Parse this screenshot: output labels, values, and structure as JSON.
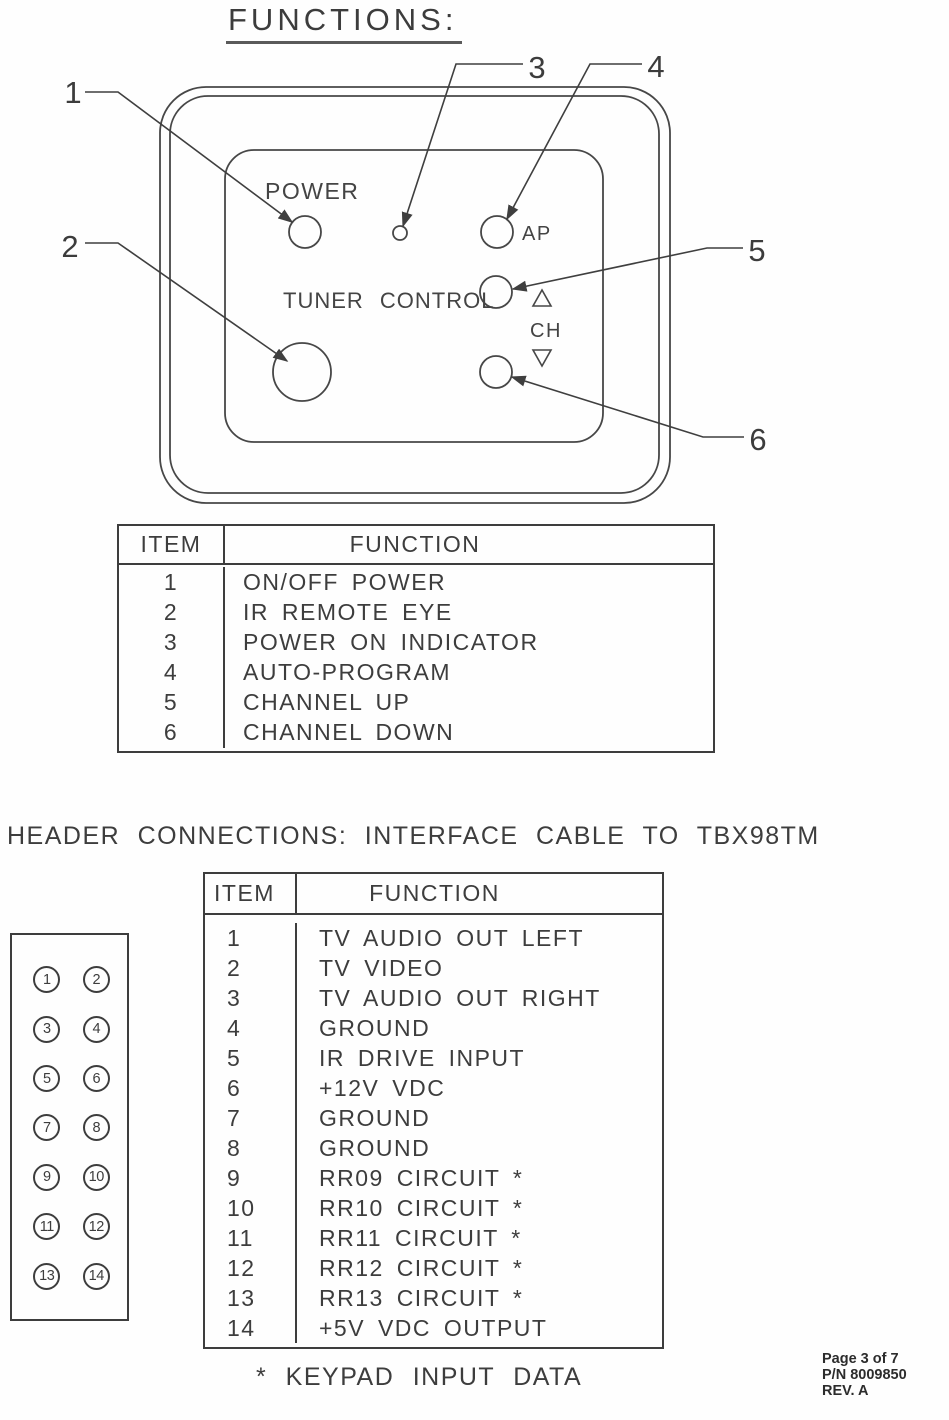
{
  "colors": {
    "paper": "#fefefe",
    "ink": "#3d3d3d"
  },
  "title": "FUNCTIONS:",
  "panel": {
    "power_label": "POWER",
    "tuner_control_label": "TUNER CONTROL",
    "ap_label": "AP",
    "ch_label": "CH",
    "callouts": [
      "1",
      "2",
      "3",
      "4",
      "5",
      "6"
    ]
  },
  "functions_table": {
    "headers": {
      "item": "ITEM",
      "function": "FUNCTION"
    },
    "rows": [
      {
        "item": "1",
        "function": "ON/OFF POWER"
      },
      {
        "item": "2",
        "function": "IR REMOTE EYE"
      },
      {
        "item": "3",
        "function": "POWER ON INDICATOR"
      },
      {
        "item": "4",
        "function": "AUTO-PROGRAM"
      },
      {
        "item": "5",
        "function": "CHANNEL UP"
      },
      {
        "item": "6",
        "function": "CHANNEL DOWN"
      }
    ]
  },
  "connections_heading": "HEADER CONNECTIONS: INTERFACE CABLE TO TBX98TM",
  "connector": {
    "pins": [
      "1",
      "2",
      "3",
      "4",
      "5",
      "6",
      "7",
      "8",
      "9",
      "10",
      "11",
      "12",
      "13",
      "14"
    ]
  },
  "connections_table": {
    "headers": {
      "item": "ITEM",
      "function": "FUNCTION"
    },
    "rows": [
      {
        "item": "1",
        "function": "TV AUDIO OUT LEFT"
      },
      {
        "item": "2",
        "function": "TV VIDEO"
      },
      {
        "item": "3",
        "function": "TV AUDIO OUT RIGHT"
      },
      {
        "item": "4",
        "function": "GROUND"
      },
      {
        "item": "5",
        "function": "IR DRIVE INPUT"
      },
      {
        "item": "6",
        "function": "+12V VDC"
      },
      {
        "item": "7",
        "function": "GROUND"
      },
      {
        "item": "8",
        "function": "GROUND"
      },
      {
        "item": "9",
        "function": "RR09 CIRCUIT *"
      },
      {
        "item": "10",
        "function": "RR10 CIRCUIT *"
      },
      {
        "item": "11",
        "function": "RR11 CIRCUIT *"
      },
      {
        "item": "12",
        "function": "RR12 CIRCUIT *"
      },
      {
        "item": "13",
        "function": "RR13 CIRCUIT *"
      },
      {
        "item": "14",
        "function": "+5V VDC OUTPUT"
      }
    ]
  },
  "footnote": "* KEYPAD INPUT DATA",
  "footer": {
    "page": "Page 3 of 7",
    "part_number": "P/N 8009850",
    "revision": "REV. A"
  }
}
